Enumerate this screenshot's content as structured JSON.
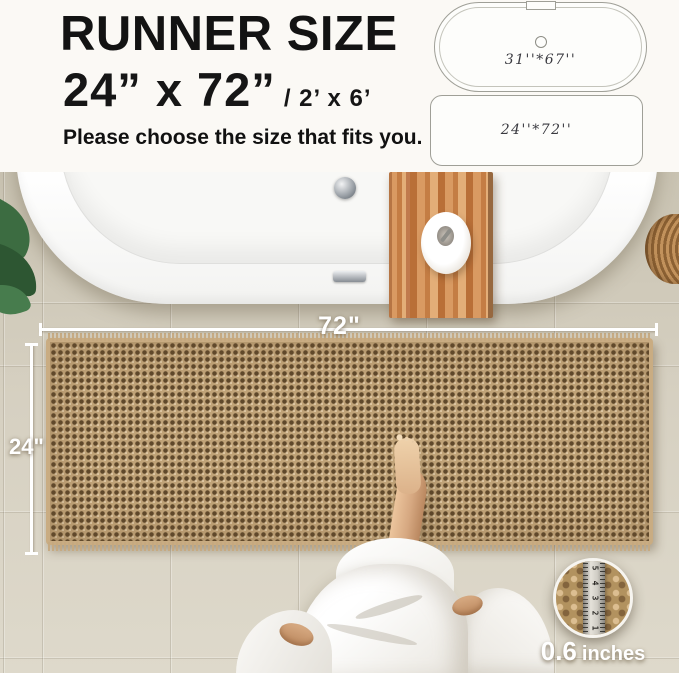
{
  "header": {
    "title": "RUNNER SIZE",
    "size_main": "24”  x 72”",
    "size_alt": "/ 2’ x 6’",
    "subtitle": "Please choose the size that fits you."
  },
  "size_diagram": {
    "bathtub_label": "31''*67''",
    "runner_label": "24''*72''"
  },
  "dimensions": {
    "width_label": "72\"",
    "height_label": "24\""
  },
  "thickness": {
    "value": "0.6",
    "unit": "inches",
    "ruler_numbers": [
      "5",
      "4",
      "3",
      "2",
      "1"
    ]
  },
  "colors": {
    "header_background": "#fbf9f5",
    "text": "#131313",
    "rug": "#b5966d",
    "rug_hole": "#5f482b",
    "floor_tile": "#d6d0c1",
    "wood_tray": "#c47d44",
    "robe": "#f4f2ee",
    "dimension_line": "#ffffff"
  }
}
